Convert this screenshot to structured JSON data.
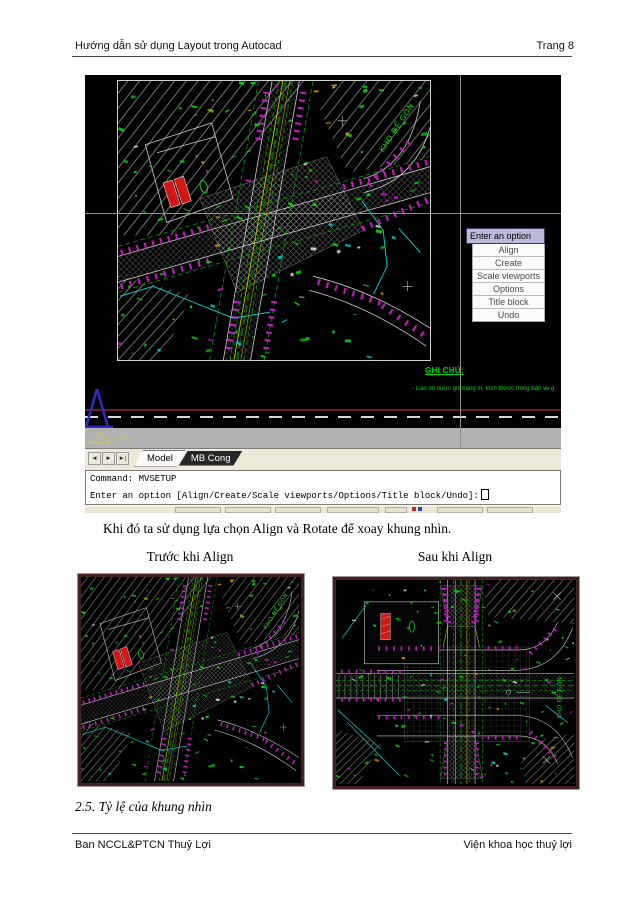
{
  "document": {
    "header": {
      "title_left": "Hướng dẫn sử dụng Layout trong Autocad",
      "page_label": "Trang 8"
    },
    "paragraph": "Khi đó ta sử dụng lựa chọn Align và Rotate để xoay khung nhìn.",
    "caption_before": "Trước khi Align",
    "caption_after": "Sau khi Align",
    "section_heading": "2.5. Tỷ lệ của khung nhìn",
    "footer": {
      "left": "Ban NCCL&PTCN Thuỷ Lợi",
      "right": "Viện khoa học thuỷ lợi"
    }
  },
  "autocad": {
    "context_menu": {
      "title": "Enter an option",
      "items": [
        "Align",
        "Create",
        "Scale viewports",
        "Options",
        "Title block",
        "Undo"
      ]
    },
    "layout_tabs": {
      "nav": [
        "◄",
        "►",
        "►|"
      ],
      "model": "Model",
      "layout": "MB Cong"
    },
    "command": {
      "line1": "Command: MVSETUP",
      "line2": "Enter an option [Align/Create/Scale viewports/Options/Title block/Undo]:"
    },
    "notes": {
      "title": "GHI CHÚ:",
      "line": "- Cao độ được ghi bằng m, kích thước trong bản vẽ g",
      "road_label": "KHO ĐỂ GÒN"
    }
  },
  "colors": {
    "page-bg": "#ffffff",
    "text": "#000000",
    "menu-header-bg": "#b9b9da",
    "menu-item-text": "#4a4a4a",
    "beige": "#ece9d8",
    "scroll-gray": "#b2b2b2",
    "tab-dark-bg": "#262626",
    "cad-green": "#00d800",
    "cad-green-dim": "#00a000",
    "cad-magenta": "#c617c6",
    "cad-cyan": "#00c8c8",
    "cad-yellow": "#d8d800",
    "cad-red": "#d41616",
    "dark-red-line": "#6b1d1d",
    "crosshair": "#909090",
    "maroon-border": "#46221e"
  }
}
